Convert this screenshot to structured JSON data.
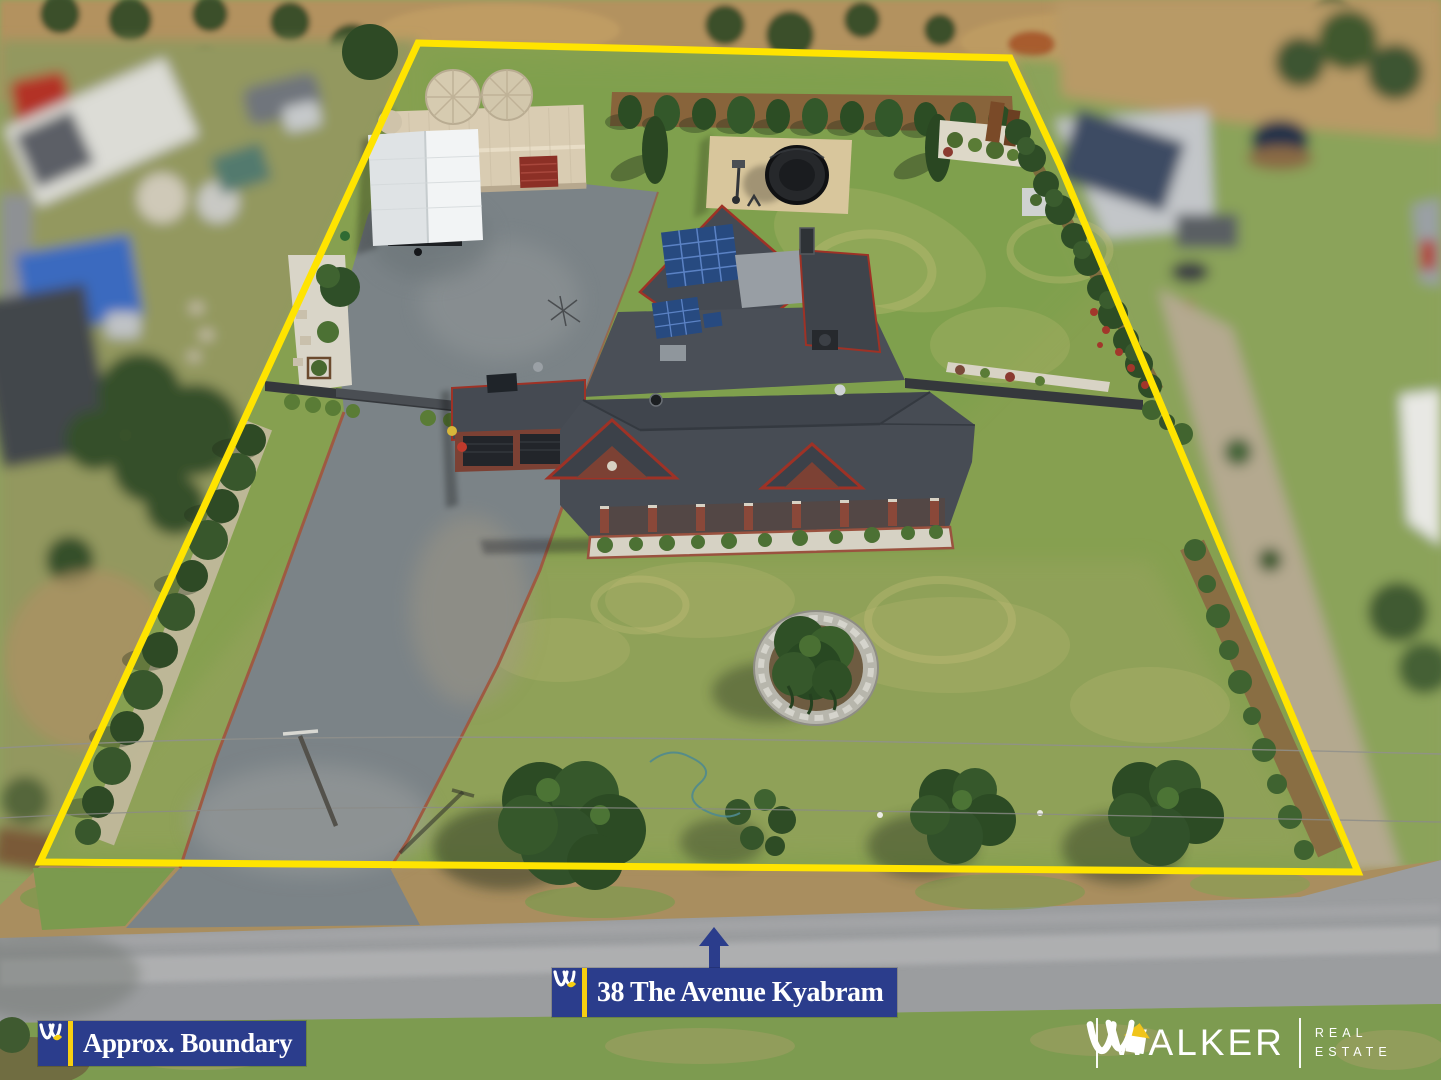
{
  "address_banner": {
    "text": "38 The Avenue Kyabram"
  },
  "boundary_banner": {
    "text": "Approx. Boundary"
  },
  "brand_footer": {
    "name": "WALKER",
    "division_line1": "REAL",
    "division_line2": "ESTATE"
  },
  "colors": {
    "boundary_line": "#FFE400",
    "banner_bg": "#2B3D8C",
    "banner_text": "#FFFFFF",
    "accent_yellow": "#F7CF11",
    "arrow": "#2B3D8C",
    "brand_text": "#FFFFFF",
    "brand_roof_yellow": "#F0C41B"
  }
}
